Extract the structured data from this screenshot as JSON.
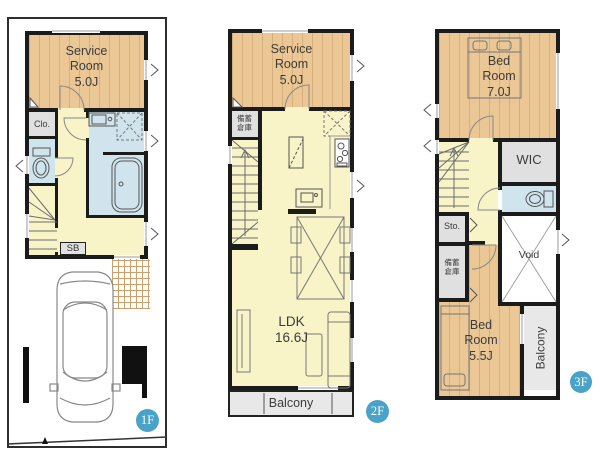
{
  "palette": {
    "wood_floor": "#eac795",
    "hall_floor": "#f8f4c8",
    "wet_room": "#cfe4ec",
    "storage_gray": "#e0e0e0",
    "balcony_gray": "#e8e8e8",
    "wall": "#1b1b1b",
    "badge_blue": "#49a2c8"
  },
  "f1": {
    "badge": "1F",
    "service": {
      "name": "Service Room",
      "size": "5.0J"
    },
    "closet": "Clo.",
    "shoebox": "SB"
  },
  "f2": {
    "badge": "2F",
    "service": {
      "name": "Service Room",
      "size": "5.0J"
    },
    "stock": {
      "l1": "備蓄",
      "l2": "倉庫"
    },
    "ldk": {
      "name": "LDK",
      "size": "16.6J"
    },
    "balcony": "Balcony"
  },
  "f3": {
    "badge": "3F",
    "bed7": {
      "name": "Bed Room",
      "size": "7.0J"
    },
    "wic": "WIC",
    "sto": "Sto.",
    "stock": {
      "l1": "備蓄",
      "l2": "倉庫"
    },
    "void": "Void",
    "bed5": {
      "name": "Bed Room",
      "size": "5.5J"
    },
    "balcony": "Balcony"
  }
}
